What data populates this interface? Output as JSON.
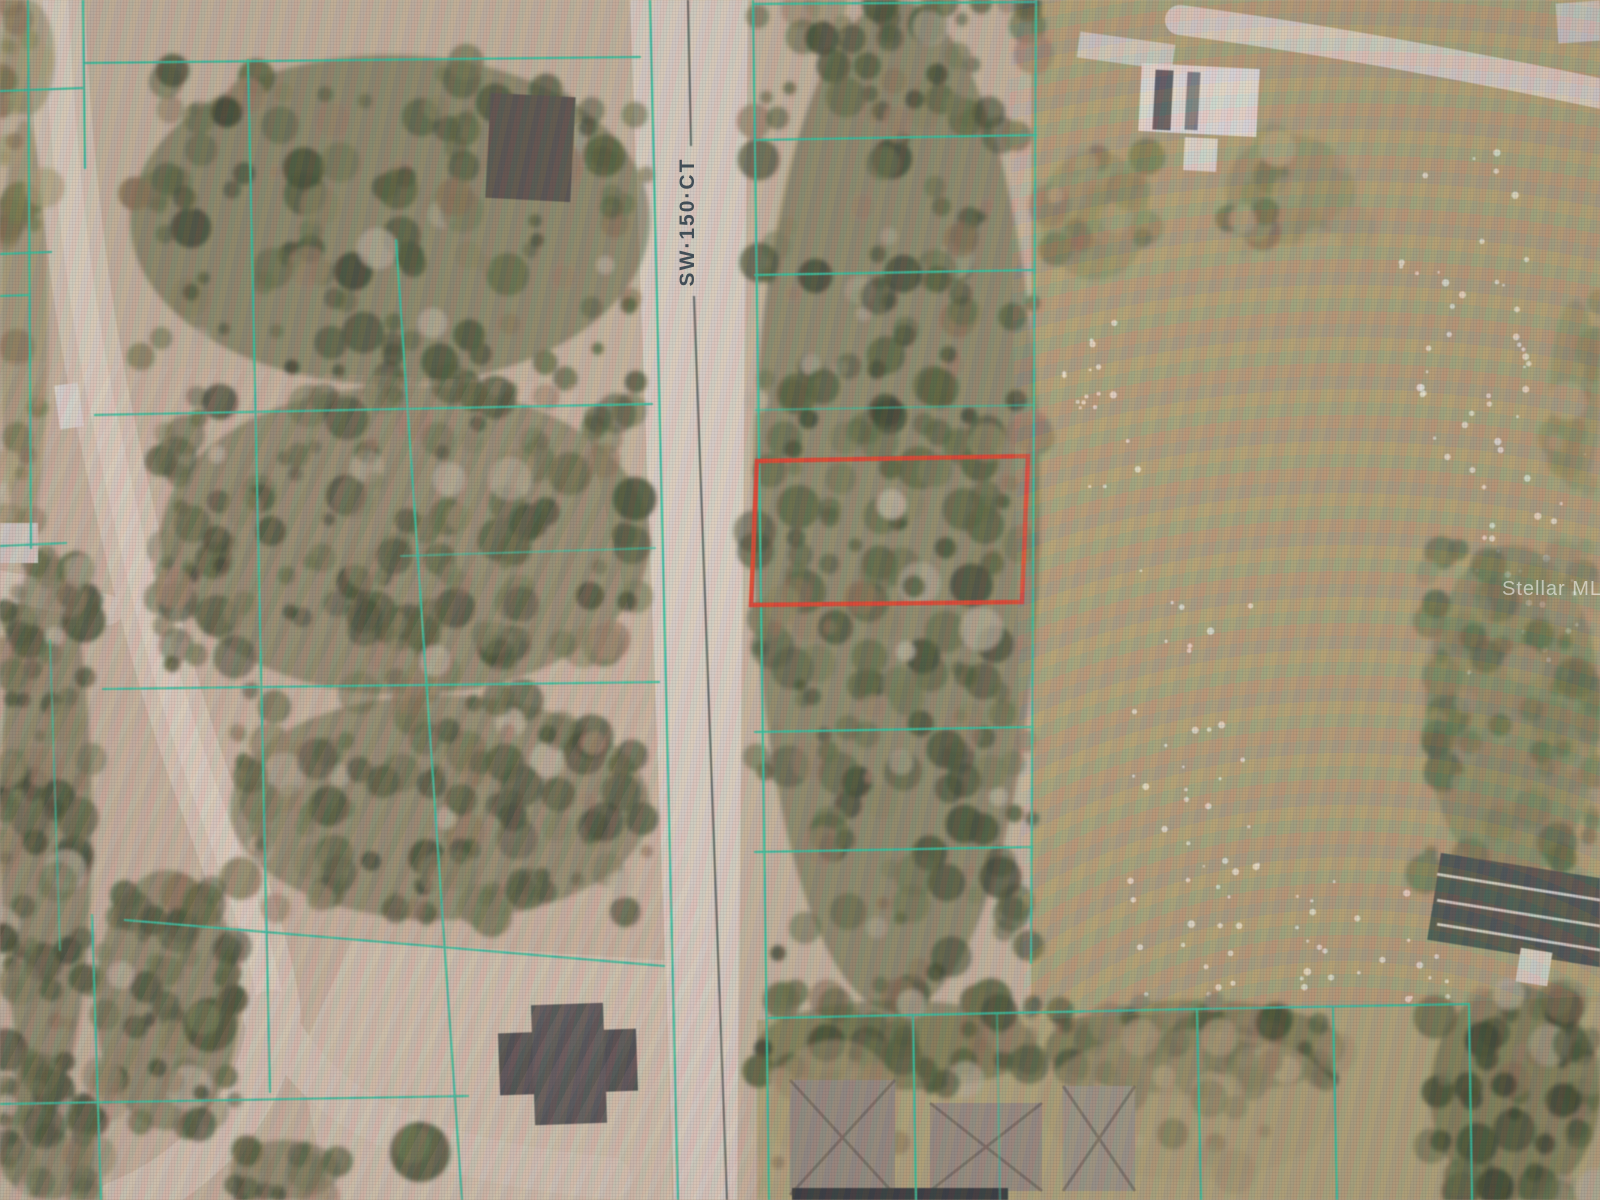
{
  "road_label": {
    "text": "SW·150·CT"
  },
  "watermark": {
    "text": "Stellar MLS",
    "color": "rgba(255,255,255,0.55)"
  },
  "colors": {
    "base": "#c2b199",
    "parcel_line": "#19c39b",
    "highlight": "#e8311a",
    "centerline": "#3d4d49",
    "field": "#a89a6b",
    "lawn": "#aca073",
    "clearing": "#cec0ab",
    "road": "#d9cfc2"
  },
  "areas": [
    {
      "name": "open-field",
      "fill": "#a89a6b",
      "pts": [
        [
          1031,
          0
        ],
        [
          1600,
          0
        ],
        [
          1600,
          1004
        ],
        [
          1470,
          1004
        ],
        [
          1197,
          1011
        ],
        [
          1031,
          1016
        ]
      ]
    },
    {
      "name": "residential-lawns",
      "fill": "#aca073",
      "pts": [
        [
          757,
          1020
        ],
        [
          1197,
          1011
        ],
        [
          1470,
          1004
        ],
        [
          1600,
          1002
        ],
        [
          1600,
          1200
        ],
        [
          757,
          1200
        ]
      ]
    },
    {
      "name": "cleared-lot",
      "fill": "#cec0ab",
      "pts": [
        [
          352,
          940
        ],
        [
          665,
          960
        ],
        [
          672,
          1200
        ],
        [
          330,
          1200
        ],
        [
          298,
          1060
        ]
      ]
    }
  ],
  "roads": [
    {
      "name": "sw-150-ct-roadbed",
      "pts": [
        [
          630,
          0
        ],
        [
          748,
          0
        ],
        [
          737,
          1200
        ],
        [
          674,
          1200
        ]
      ],
      "fill": "#d9cfc2"
    },
    {
      "name": "dirt-road",
      "d": "M 55 -12 C 60 120 75 280 105 420 C 135 560 162 680 212 810 C 242 892 266 962 272 1015",
      "w": 58,
      "s": "#d3c5b2"
    },
    {
      "name": "dirt-road-core",
      "d": "M 55 -12 C 60 120 75 280 105 420 C 135 560 162 680 212 810 C 242 892 266 962 272 1015",
      "w": 26,
      "s": "#ded3c3",
      "op": 0.85
    },
    {
      "name": "dirt-road-branch-southwest",
      "d": "M 272 1015 C 270 1075 236 1124 196 1158 C 166 1184 142 1196 118 1206",
      "w": 50,
      "s": "#d3c5b2"
    },
    {
      "name": "dirt-road-branch-east",
      "d": "M 272 1015 C 300 1070 342 1112 420 1140 C 482 1162 545 1172 610 1178",
      "w": 42,
      "s": "#d3c6b4",
      "op": 0.9
    },
    {
      "name": "driveway-west",
      "d": "M -5 585 C 40 592 72 600 108 610",
      "w": 30,
      "s": "#d6c9b8",
      "op": 0.9
    },
    {
      "name": "driveway-northeast",
      "d": "M 1180 20 C 1300 36 1452 62 1612 96",
      "w": 30,
      "s": "#dbd3c6",
      "op": 0.95
    },
    {
      "name": "driveway-house-l",
      "d": "M 581 128 L 581 160 L 606 162",
      "w": 13,
      "s": "#e2dcd1",
      "op": 0.9
    }
  ],
  "speckles": [
    {
      "x": 1130,
      "y": 560,
      "w": 130,
      "h": 450,
      "n": 45
    },
    {
      "x": 1400,
      "y": 150,
      "w": 130,
      "h": 330,
      "n": 40
    },
    {
      "x": 1290,
      "y": 880,
      "w": 160,
      "h": 130,
      "n": 25
    },
    {
      "x": 1462,
      "y": 430,
      "w": 125,
      "h": 250,
      "n": 30
    },
    {
      "x": 1060,
      "y": 300,
      "w": 80,
      "h": 200,
      "n": 18
    }
  ],
  "palettes": {
    "dense": {
      "base": "#46512c",
      "dots": [
        "#2c3a21",
        "#37472a",
        "#41512f",
        "#4d5c36",
        "#5a653d",
        "#37472a",
        "#41512f",
        "#2c3a21",
        "#68704a",
        "#7e7b55",
        "#7c6a4a",
        "#8d785c",
        "#b3ac94",
        "#55623a",
        "#47552e",
        "#334224"
      ]
    },
    "scrub": {
      "base": "#7e7e50",
      "dots": [
        "#5d6538",
        "#6c7240",
        "#797b4a",
        "#8b8b59",
        "#7c6948",
        "#9b9268",
        "#86854f",
        "#a79d72"
      ]
    },
    "green": {
      "base": "#5e6b3f",
      "dots": [
        "#4a5a33",
        "#57673c",
        "#657244",
        "#72794a",
        "#83855a",
        "#4f6036",
        "#8f8c62"
      ]
    },
    "dry": {
      "base": "#a3946b",
      "dots": [
        "#9b8a63",
        "#a89770",
        "#8f7c58",
        "#b3a27a",
        "#7d7b52",
        "#97906a"
      ]
    }
  },
  "vegetation": [
    [
      130,
      55,
      520,
      330,
      130,
      "dense"
    ],
    [
      160,
      385,
      490,
      310,
      150,
      "dense"
    ],
    [
      230,
      695,
      420,
      225,
      110,
      "dense"
    ],
    [
      95,
      870,
      145,
      260,
      48,
      "dense"
    ],
    [
      0,
      545,
      92,
      560,
      85,
      "dense"
    ],
    [
      0,
      1105,
      95,
      95,
      26,
      "dense"
    ],
    [
      753,
      0,
      287,
      1012,
      280,
      "dense"
    ],
    [
      1430,
      985,
      170,
      215,
      60,
      "dense"
    ],
    [
      230,
      1140,
      110,
      60,
      16,
      "dense"
    ],
    [
      1045,
      1000,
      300,
      95,
      42,
      "dense"
    ],
    [
      757,
      1000,
      280,
      90,
      36,
      "dense"
    ],
    [
      1040,
      150,
      110,
      130,
      26,
      "scrub"
    ],
    [
      1225,
      135,
      130,
      110,
      20,
      "scrub"
    ],
    [
      1550,
      300,
      50,
      190,
      12,
      "scrub"
    ],
    [
      0,
      0,
      55,
      115,
      12,
      "scrub"
    ],
    [
      0,
      120,
      48,
      420,
      20,
      "scrub"
    ],
    [
      1425,
      545,
      175,
      335,
      70,
      "green"
    ],
    [
      1040,
      1030,
      300,
      150,
      22,
      "dry"
    ],
    [
      770,
      1040,
      130,
      140,
      14,
      "dry"
    ]
  ],
  "single_trees": [
    [
      210,
      1025,
      27
    ],
    [
      420,
      1152,
      30
    ]
  ],
  "buildings": [
    [
      488,
      95,
      85,
      105,
      "#4d4a43",
      3,
      0,
      "dark-roof-house"
    ],
    [
      1078,
      38,
      96,
      26,
      "#cfcabf",
      8,
      0,
      "trailer"
    ],
    [
      1140,
      66,
      118,
      68,
      "#e6e3db",
      3,
      0,
      "white-roof-house"
    ],
    [
      1154,
      70,
      18,
      60,
      "#4b4f53",
      3,
      0,
      "roof-section"
    ],
    [
      1186,
      72,
      13,
      58,
      "#71757a",
      3,
      0,
      "roof-section"
    ],
    [
      1184,
      138,
      33,
      33,
      "#dedbd2",
      3,
      0,
      "shed"
    ],
    [
      499,
      1031,
      138,
      62,
      "#3e4243",
      -2,
      0,
      "house-under-construction"
    ],
    [
      533,
      1004,
      72,
      120,
      "#444849",
      -2,
      0,
      "house-under-construction"
    ],
    [
      790,
      1080,
      105,
      115,
      "#8e8579",
      0,
      1,
      "house-hip-roof"
    ],
    [
      930,
      1103,
      112,
      88,
      "#91877a",
      0,
      1,
      "house-hip-roof"
    ],
    [
      1063,
      1086,
      72,
      105,
      "#97907f",
      0,
      1,
      "house-hip-roof"
    ],
    [
      792,
      1188,
      216,
      14,
      "#272e33",
      0,
      0,
      "dark-flat-roof"
    ],
    [
      1433,
      866,
      175,
      88,
      "#39453c",
      9,
      0,
      "greenhouse"
    ],
    [
      1436,
      886,
      170,
      3,
      "#cfd4cb",
      9,
      0,
      "greenhouse-frame"
    ],
    [
      1436,
      912,
      170,
      3,
      "#cfd4cb",
      9,
      0,
      "greenhouse-frame"
    ],
    [
      1436,
      936,
      170,
      3,
      "#cfd4cb",
      9,
      0,
      "greenhouse-frame"
    ],
    [
      1518,
      950,
      32,
      34,
      "#d8d5cc",
      9,
      0,
      "shed"
    ],
    [
      1557,
      2,
      44,
      40,
      "#c9c6bd",
      -4,
      0,
      "vehicles"
    ],
    [
      57,
      384,
      24,
      44,
      "#dcd9d2",
      -8,
      0,
      "truck"
    ],
    [
      0,
      523,
      38,
      40,
      "#cfccc4",
      0,
      0,
      "vehicle"
    ]
  ],
  "parcel_lines": [
    [
      28,
      0,
      31,
      548
    ],
    [
      0,
      91,
      83,
      88
    ],
    [
      0,
      254,
      51,
      252
    ],
    [
      0,
      296,
      29,
      295
    ],
    [
      0,
      546,
      66,
      543
    ],
    [
      83,
      0,
      85,
      168
    ],
    [
      84,
      63,
      640,
      57
    ],
    [
      248,
      60,
      270,
      1092
    ],
    [
      95,
      415,
      652,
      404
    ],
    [
      401,
      556,
      655,
      548,
      0.6
    ],
    [
      103,
      689,
      659,
      682
    ],
    [
      125,
      920,
      664,
      966
    ],
    [
      0,
      1104,
      468,
      1096
    ],
    [
      396,
      240,
      462,
      1200
    ],
    [
      650,
      0,
      678,
      1200
    ],
    [
      753,
      0,
      769,
      1200
    ],
    [
      755,
      4,
      1036,
      2
    ],
    [
      755,
      140,
      1036,
      135
    ],
    [
      755,
      275,
      1035,
      270
    ],
    [
      756,
      410,
      1034,
      405,
      0.55
    ],
    [
      1036,
      0,
      1031,
      963
    ],
    [
      755,
      732,
      1033,
      727
    ],
    [
      755,
      852,
      1032,
      847
    ],
    [
      769,
      1018,
      1197,
      1009
    ],
    [
      1197,
      1009,
      1469,
      1004
    ],
    [
      913,
      1017,
      916,
      1200
    ],
    [
      997,
      1015,
      1000,
      1200,
      0.5
    ],
    [
      1197,
      1009,
      1201,
      1200
    ],
    [
      1333,
      1007,
      1337,
      1200
    ],
    [
      1469,
      1004,
      1472,
      1200
    ],
    [
      50,
      640,
      60,
      950,
      0.6
    ],
    [
      92,
      915,
      101,
      1200
    ]
  ],
  "road_centerline": {
    "segments": [
      [
        688,
        0,
        691,
        146
      ],
      [
        694,
        296,
        727,
        1200
      ]
    ]
  },
  "highlight_parcel": {
    "pts": [
      [
        757,
        461
      ],
      [
        1028,
        456
      ],
      [
        1022,
        602
      ],
      [
        751,
        605
      ]
    ],
    "width": 4.5
  }
}
